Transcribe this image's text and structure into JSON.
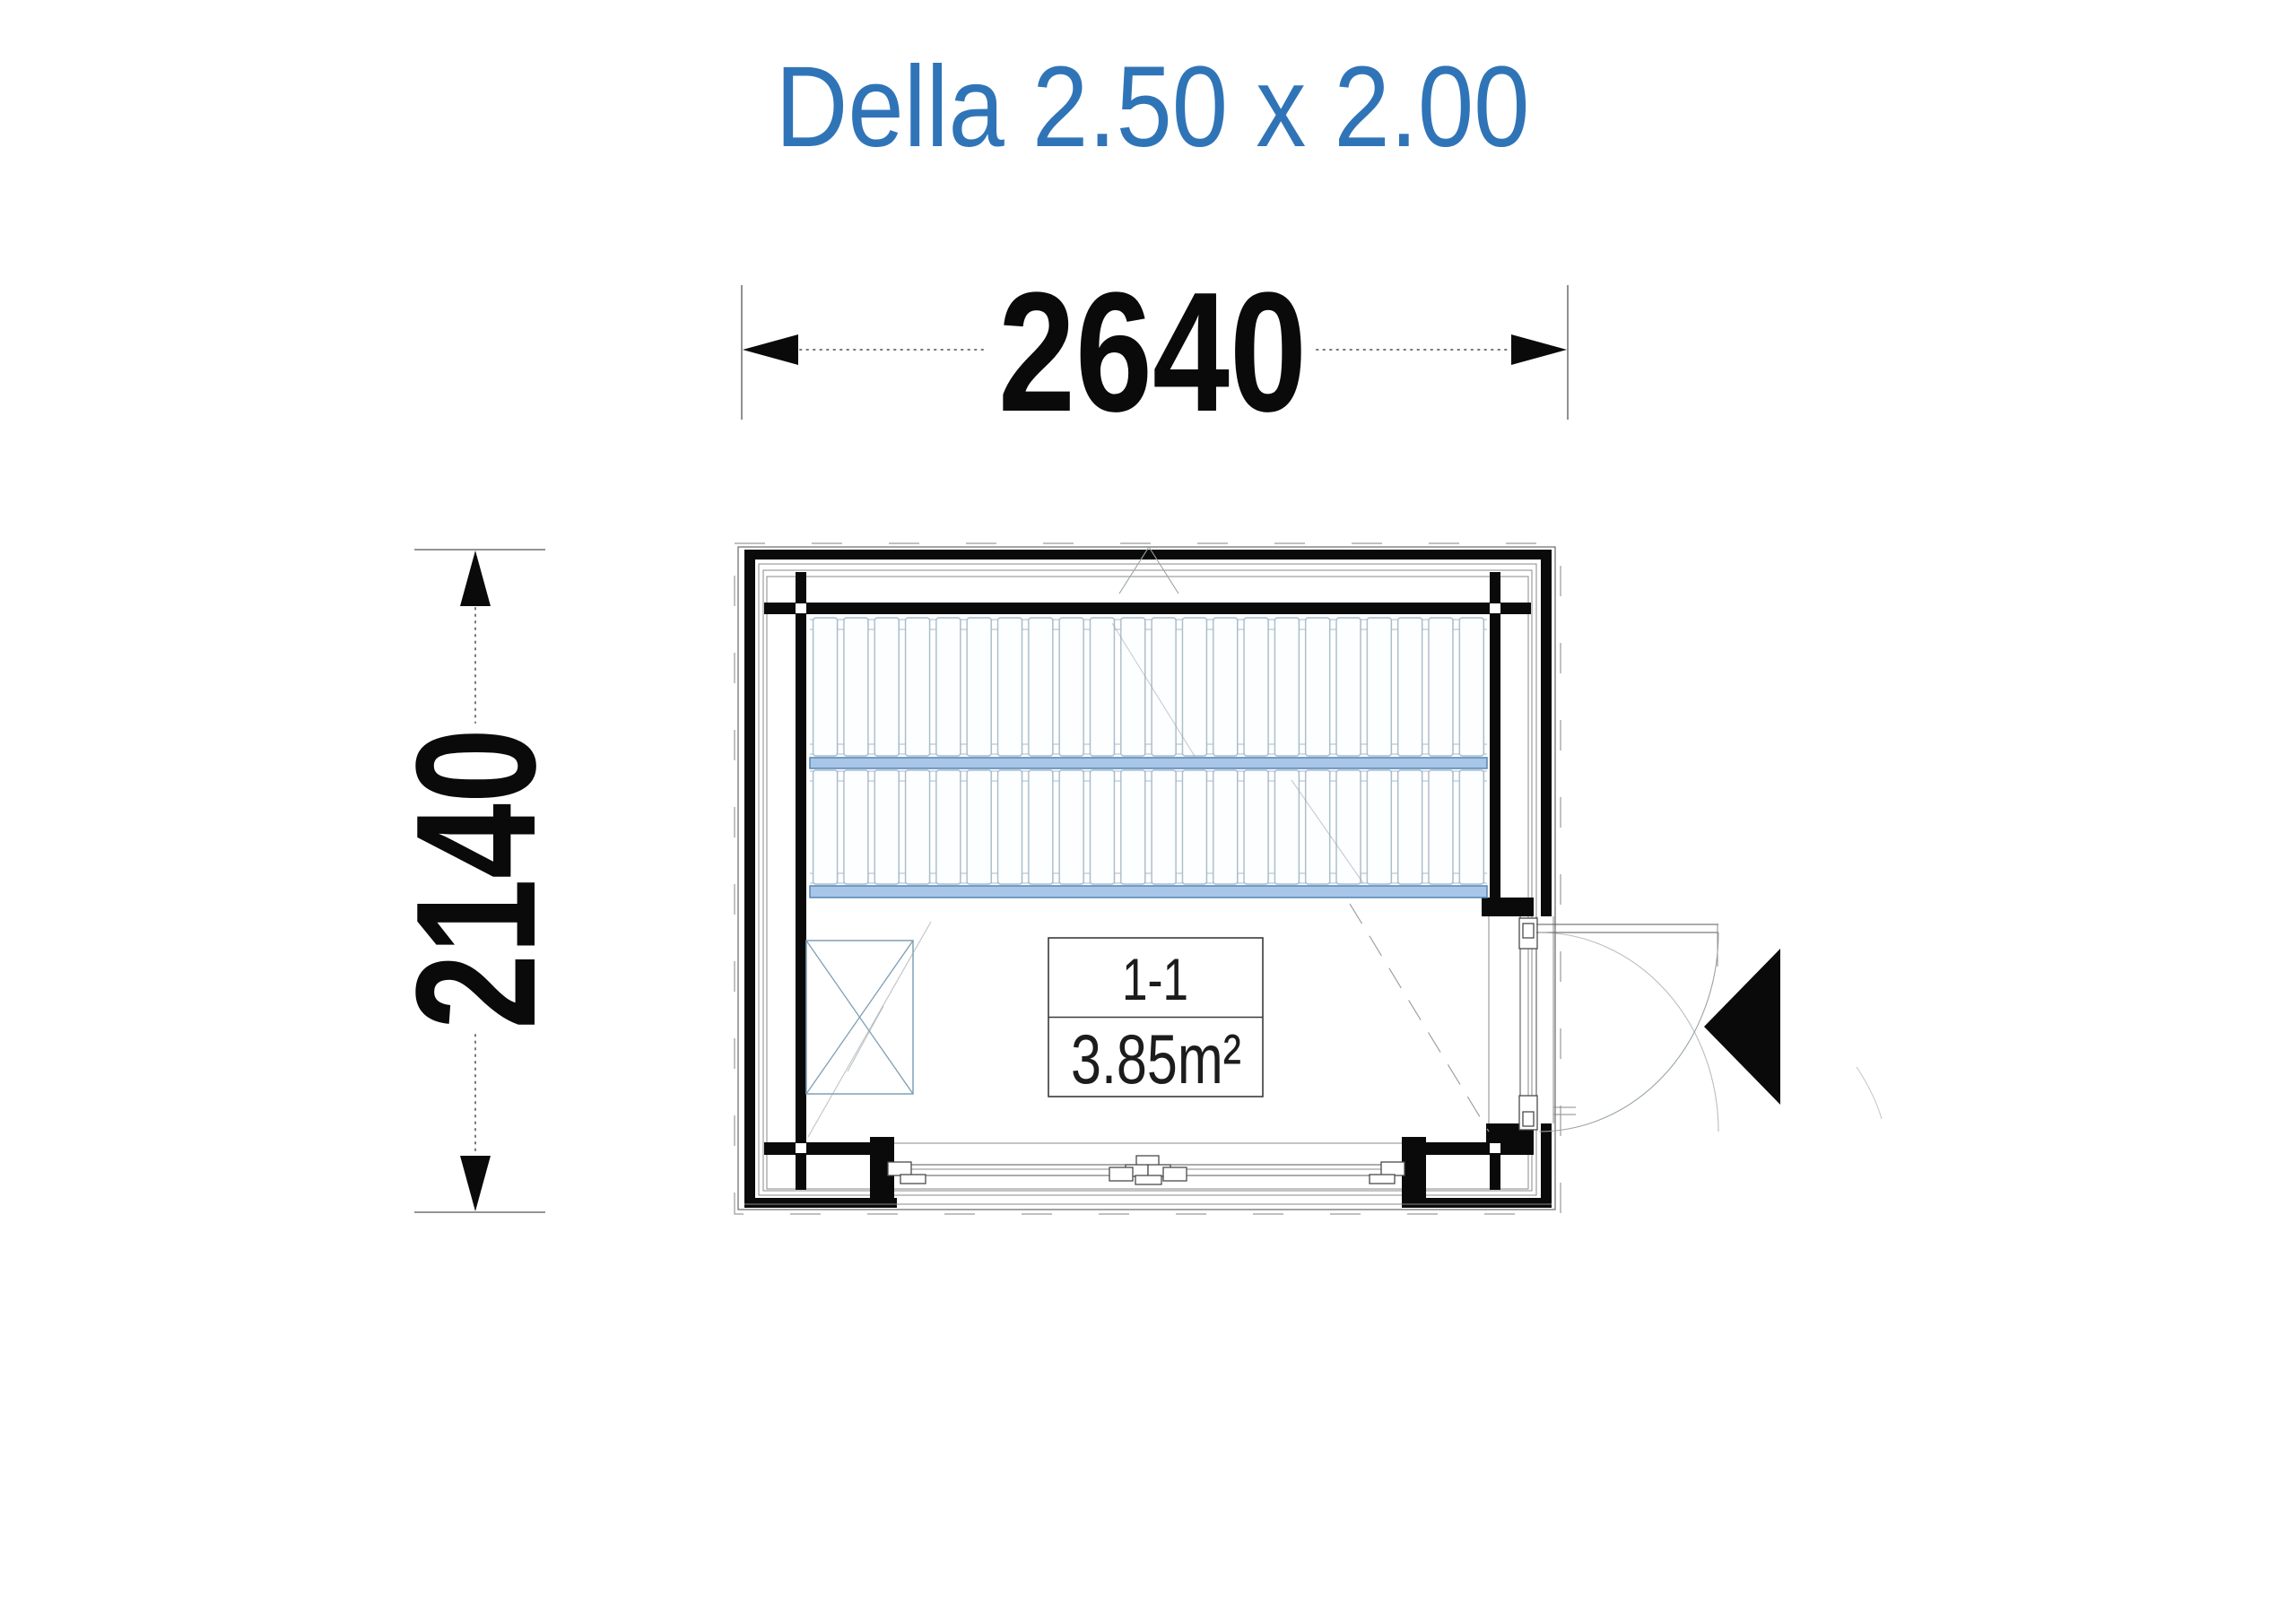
{
  "title": {
    "text": "Della 2.50 x 2.00"
  },
  "dimensions": {
    "width_mm": "2640",
    "height_mm": "2140"
  },
  "room": {
    "id": "1-1",
    "area": "3.85m²"
  },
  "icons": {
    "entrance_arrow": "solid-left-triangle",
    "heater": "crossed-box",
    "bench": "slatted-deck"
  },
  "colors": {
    "title_blue": "#3074B8",
    "bench_band_fill": "#A8C6E8",
    "bench_band_stroke": "#5585B5",
    "slat_stroke": "#A6BBCB",
    "drawing_black": "#0A0A0A"
  }
}
